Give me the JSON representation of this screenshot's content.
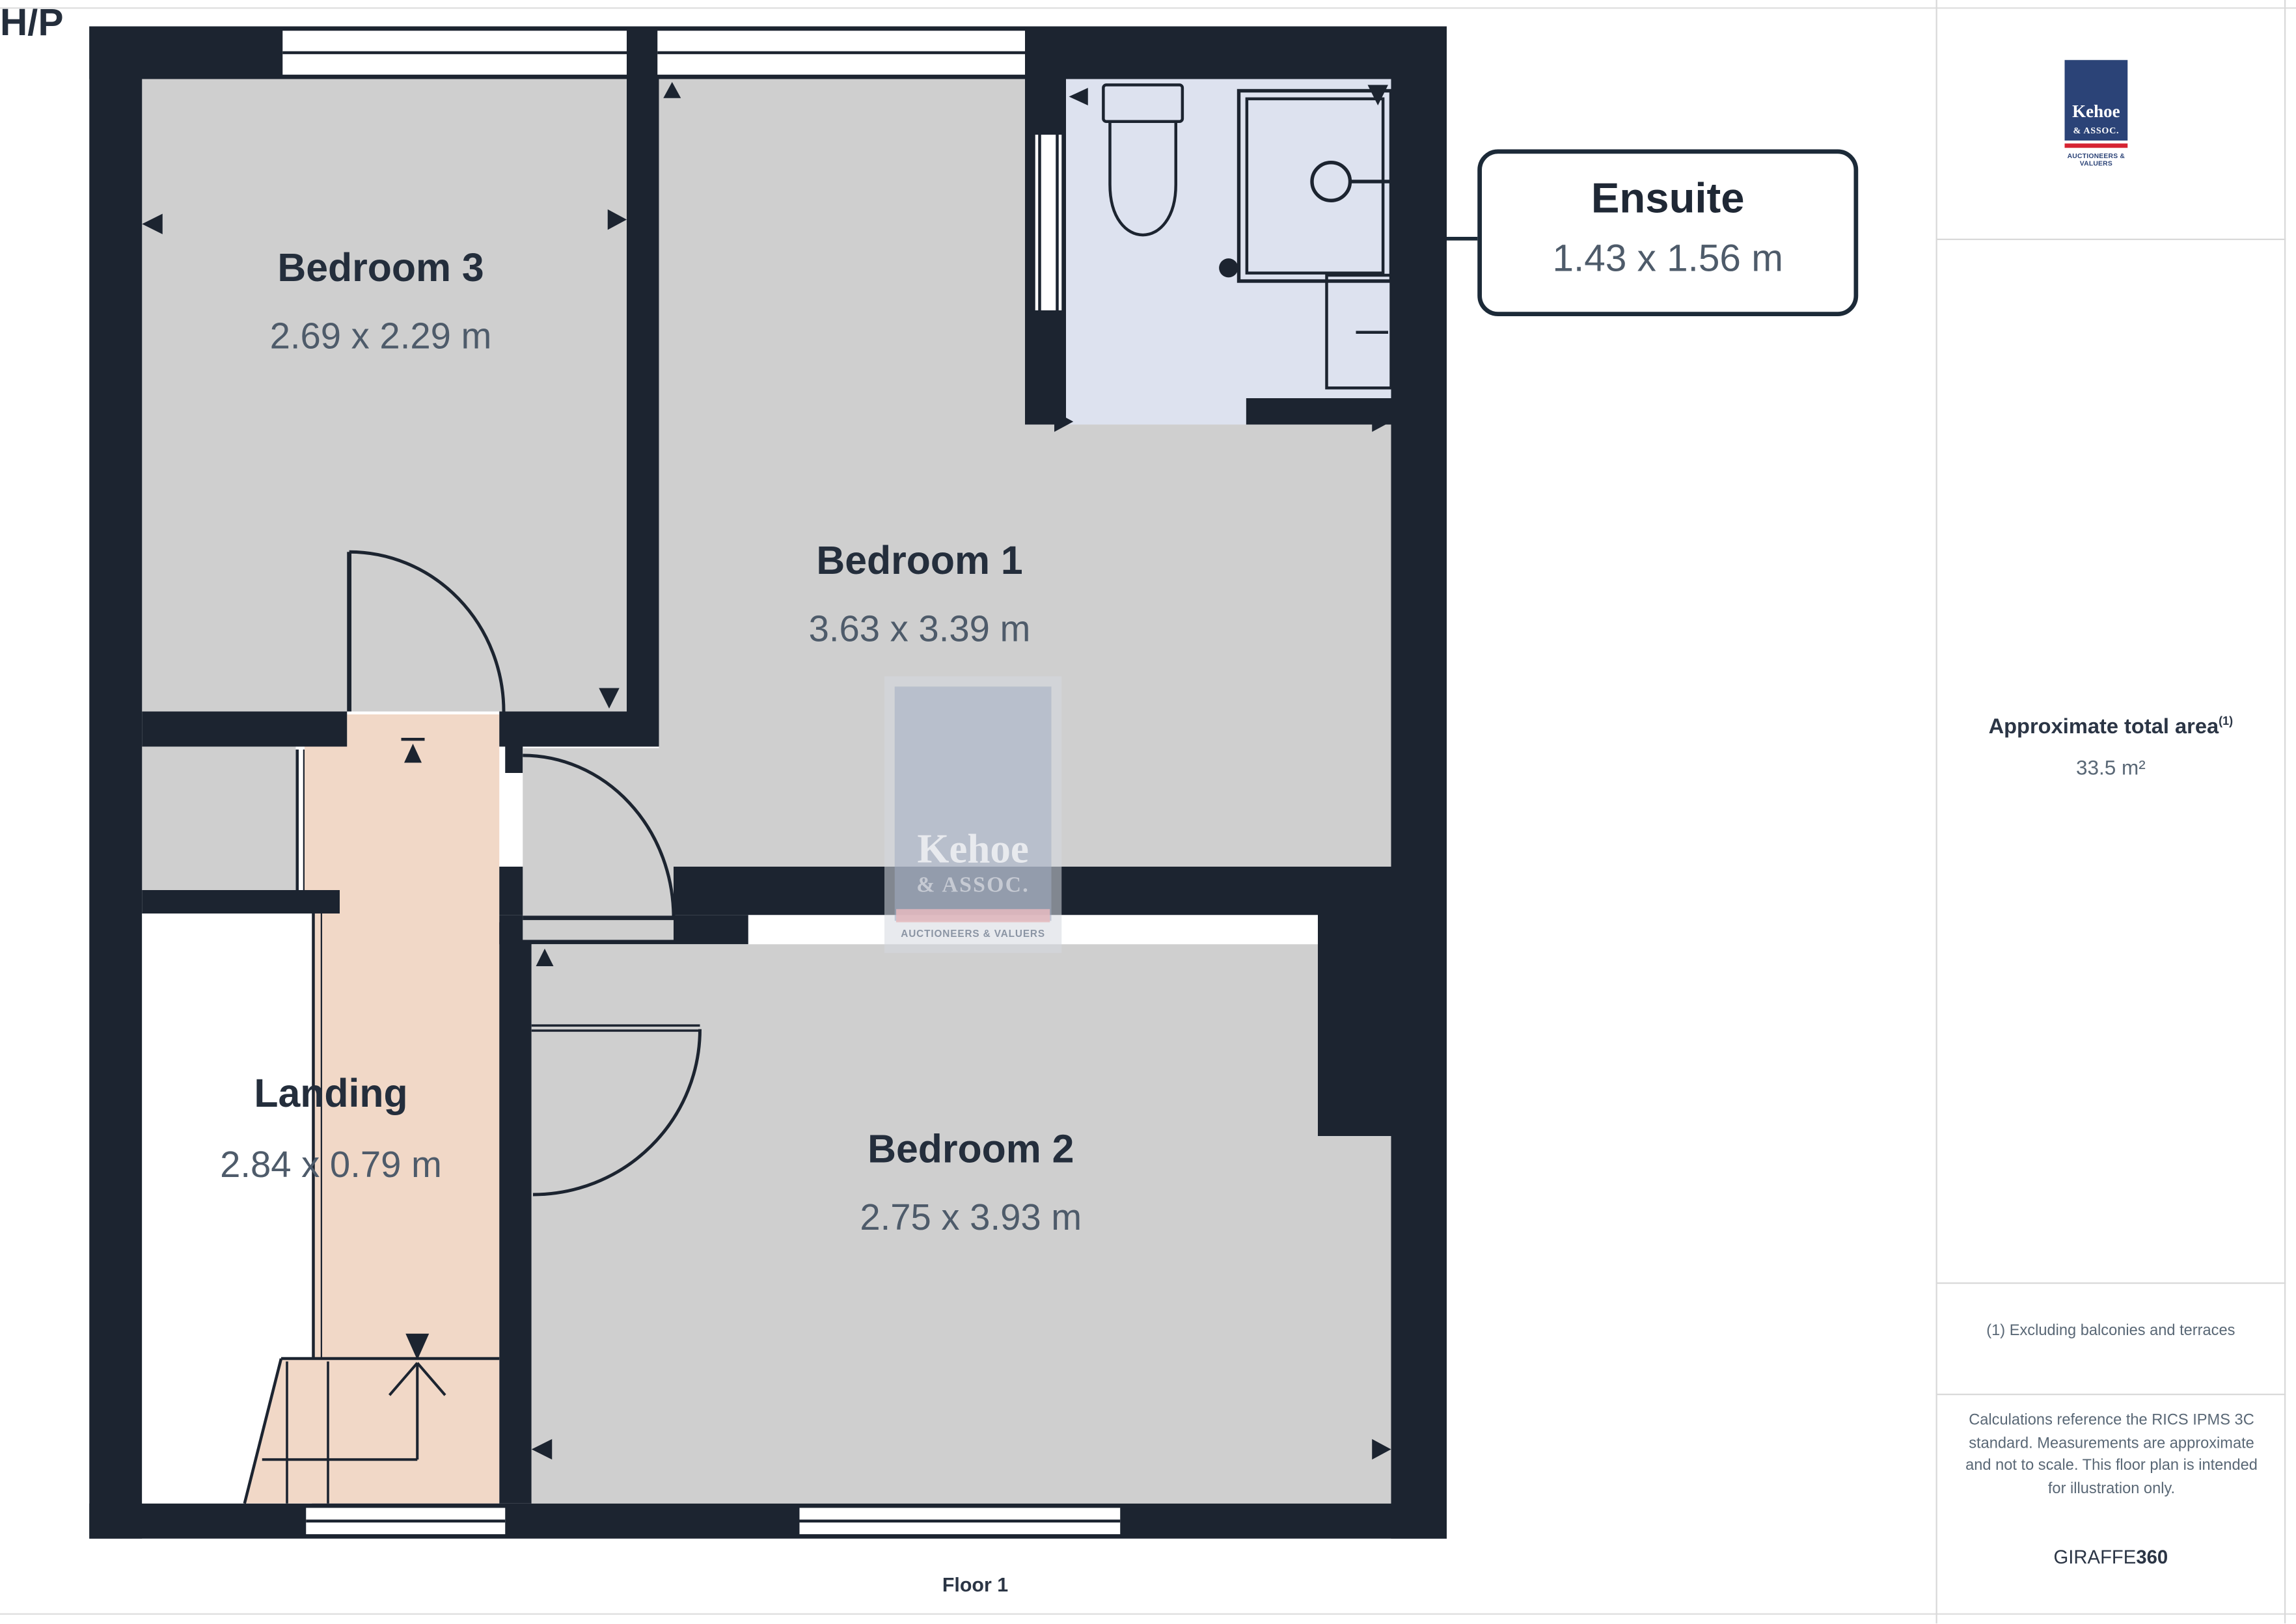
{
  "plan": {
    "rooms": [
      {
        "id": "bedroom3",
        "name": "Bedroom 3",
        "dims": "2.69 x 2.29 m"
      },
      {
        "id": "bedroom1",
        "name": "Bedroom 1",
        "dims": "3.63 x 3.39 m"
      },
      {
        "id": "bedroom2",
        "name": "Bedroom 2",
        "dims": "2.75 x 3.93 m"
      },
      {
        "id": "landing",
        "name": "Landing",
        "dims": "2.84 x 0.79 m"
      },
      {
        "id": "hp",
        "name": "H/P",
        "dims": ""
      }
    ],
    "callout": {
      "name": "Ensuite",
      "dims": "1.43 x 1.56 m"
    },
    "floor_label": "Floor 1",
    "colors": {
      "wall": "#1c2430",
      "room": "#cfcfcf",
      "landing": "#f1d8c7",
      "ensuite": "#dde2ef"
    }
  },
  "watermark": {
    "line1": "Kehoe",
    "line2": "& ASSOC.",
    "line3": "AUCTIONEERS & VALUERS"
  },
  "sidebar": {
    "logo": {
      "line1": "Kehoe",
      "line2": "& ASSOC.",
      "line3": "AUCTIONEERS & VALUERS"
    },
    "area_title": "Approximate total area",
    "area_sup": "(1)",
    "area_value": "33.5 m²",
    "footnote": "(1) Excluding balconies and terraces",
    "disclaimer": "Calculations reference the RICS IPMS 3C standard. Measurements are approximate and not to scale. This floor plan is intended for illustration only.",
    "brand_regular": "GIRAFFE",
    "brand_bold": "360"
  }
}
